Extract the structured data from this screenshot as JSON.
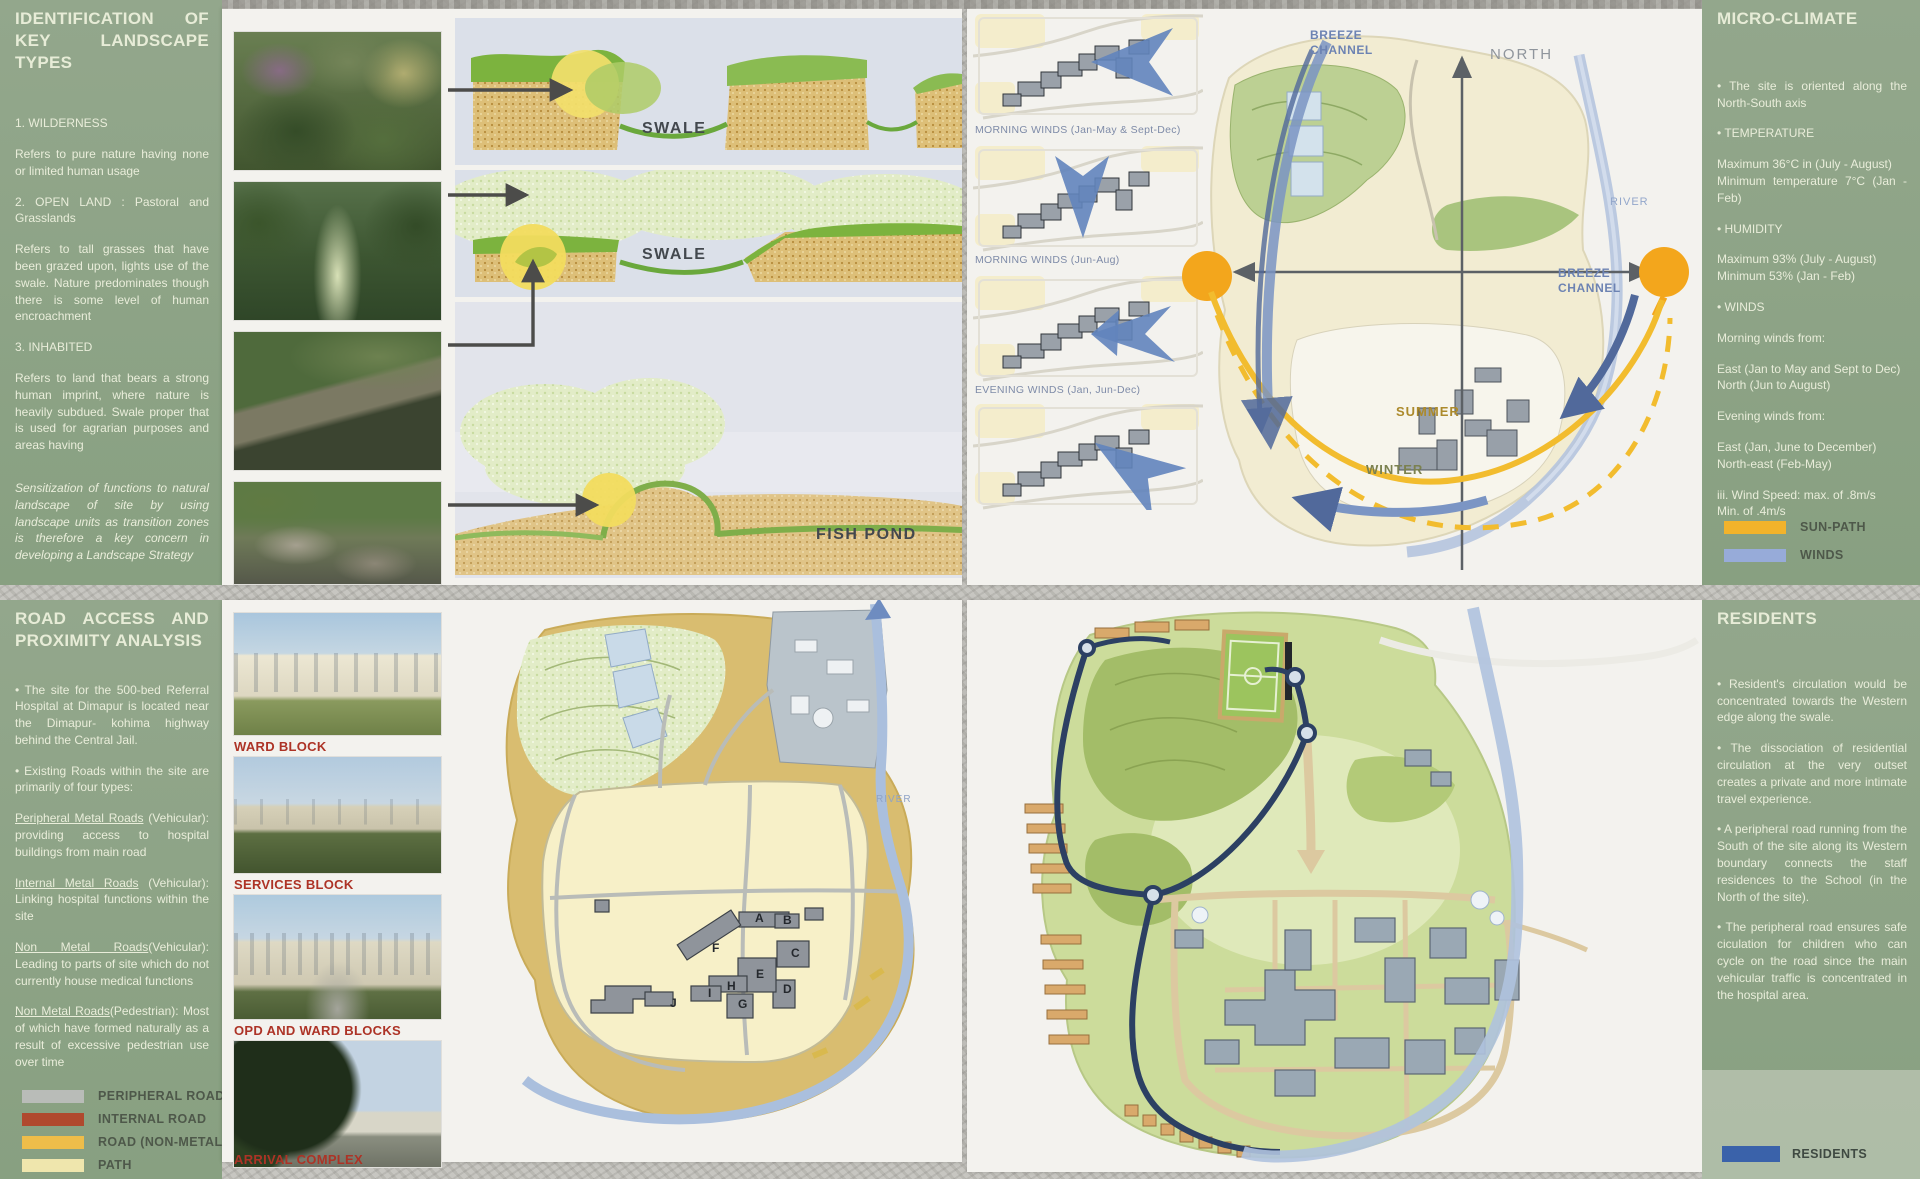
{
  "colors": {
    "panel_green": "#8da287",
    "photo_label_red": "#ad3326",
    "sun_path": "#f2b32b",
    "winds_blue": "#97abd9",
    "peripheral_road": "#b9bcb8",
    "internal_road": "#b0492e",
    "road_non_metal": "#eebd4a",
    "path_legend": "#efe6ad",
    "residents_blue": "#3a62aa"
  },
  "tl": {
    "panel": {
      "title": "IDENTIFICATION OF KEY LANDSCAPE TYPES",
      "paras": [
        "1.   WILDERNESS",
        "Refers to pure nature having none or limited human usage",
        "2.   OPEN LAND : Pastoral and Grasslands",
        "Refers to tall grasses that have been grazed upon, lights use of the swale. Nature predominates though there is some level of human encroachment",
        "3.   INHABITED",
        "Refers to land that bears a strong human imprint, where nature is heavily subdued. Swale proper that is used for agrarian purposes and areas having",
        "Sensitization of functions to natural landscape of site by using landscape units as transition zones is therefore a key concern in developing a Landscape Strategy"
      ]
    },
    "diagram_labels": {
      "swale_upper": "SWALE",
      "swale_lower": "SWALE",
      "fish_pond": "FISH POND"
    }
  },
  "tr": {
    "wind_diagrams": [
      {
        "label": "MORNING WINDS (Jan-May & Sept-Dec)"
      },
      {
        "label": "MORNING WINDS (Jun-Aug)"
      },
      {
        "label": "EVENING WINDS (Jan, Jun-Dec)"
      },
      {
        "label": ""
      }
    ],
    "map_labels": {
      "breeze_channel_top": "BREEZE\nCHANNEL",
      "north": "NORTH",
      "river": "RIVER",
      "breeze_channel_right": "BREEZE\nCHANNEL",
      "summer": "SUMMER",
      "winter": "WINTER"
    },
    "panel": {
      "title": "MICRO-CLIMATE",
      "paras": [
        "•   The site is oriented along the North-South axis",
        "•   TEMPERATURE",
        "Maximum 36°C in (July - August)\nMinimum temperature 7°C (Jan - Feb)",
        "•   HUMIDITY",
        "Maximum 93% (July - August)\nMinimum 53% (Jan - Feb)",
        "•   WINDS",
        "Morning winds from:",
        "East (Jan to May and Sept to Dec)\nNorth (Jun to August)",
        "Evening winds from:",
        "East (Jan, June to December)\nNorth-east (Feb-May)",
        "iii.   Wind Speed: max. of .8m/s\nMin. of .4m/s"
      ],
      "legend": [
        {
          "label": "SUN-PATH",
          "color": "#f2b32b"
        },
        {
          "label": "WINDS",
          "color": "#97abd9"
        }
      ]
    }
  },
  "bl": {
    "panel": {
      "title": "ROAD ACCESS AND PROXIMITY ANALYSIS",
      "paras": [
        {
          "text": "•   The site for the 500-bed Referral Hospital at Dimapur is located near the Dimapur- kohima highway behind the Central Jail."
        },
        {
          "text": "•   Existing Roads within the site are primarily of four types:"
        },
        {
          "lead": "Peripheral Metal Roads",
          "rest": " (Vehicular): providing access to hospital buildings from main road"
        },
        {
          "lead": "Internal Metal Roads",
          "rest": " (Vehicular): Linking hospital functions within the site"
        },
        {
          "lead": "Non Metal Roads",
          "rest": "(Vehicular): Leading to parts of site which do not currently house medical functions"
        },
        {
          "lead": "Non Metal Roads",
          "rest": "(Pedestrian): Most of which have formed naturally as a result of excessive pedestrian use over time"
        }
      ],
      "legend": [
        {
          "label": "PERIPHERAL ROAD",
          "color": "#b9bcb8"
        },
        {
          "label": "INTERNAL ROAD",
          "color": "#b0492e"
        },
        {
          "label": "ROAD (NON-METAL)",
          "color": "#eebd4a"
        },
        {
          "label": "PATH",
          "color": "#efe6ad"
        }
      ]
    },
    "photo_labels": [
      "WARD BLOCK",
      "SERVICES BLOCK",
      "OPD AND WARD BLOCKS",
      "ARRIVAL COMPLEX"
    ],
    "map": {
      "river": "RIVER",
      "letters": [
        "A",
        "B",
        "C",
        "D",
        "E",
        "F",
        "G",
        "H",
        "I",
        "J"
      ]
    }
  },
  "br": {
    "panel": {
      "title": "RESIDENTS",
      "paras": [
        "•   Resident's circulation would be concentrated towards the Western edge along the swale.",
        "•   The dissociation of residential circulation at the very outset creates a private and more intimate travel experience.",
        "•   A peripheral road running from the South of the site along its Western boundary connects the staff residences to the School (in the North of the site).",
        "•   The peripheral road ensures safe ciculation for children who can cycle on the road since the main vehicular traffic is concentrated in the hospital area."
      ],
      "legend": [
        {
          "label": "RESIDENTS",
          "color": "#3a62aa"
        }
      ]
    }
  }
}
